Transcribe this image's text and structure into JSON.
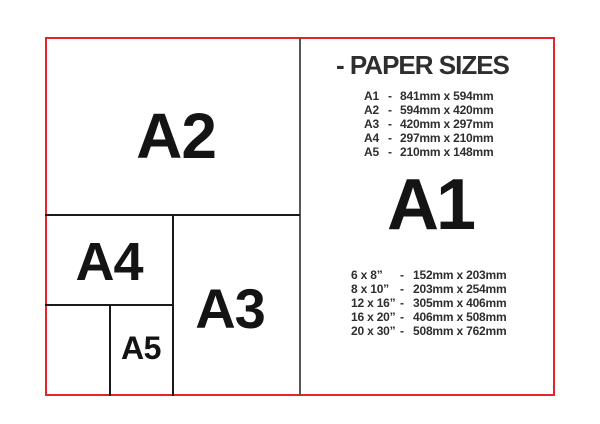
{
  "palette": {
    "frame_red": "#e8242a",
    "line_black": "#1a1a1a",
    "divider_gray": "#575757",
    "text_dark": "#2e2e2e",
    "label_black": "#141414"
  },
  "diagram": {
    "sheets": {
      "a2": "A2",
      "a3": "A3",
      "a4": "A4",
      "a5": "A5"
    }
  },
  "panel": {
    "title": "- PAPER SIZES",
    "featured_size": "A1",
    "a_series": [
      {
        "label": "A1",
        "dash": "-",
        "value": "841mm x 594mm"
      },
      {
        "label": "A2",
        "dash": "-",
        "value": "594mm x 420mm"
      },
      {
        "label": "A3",
        "dash": "-",
        "value": "420mm x 297mm"
      },
      {
        "label": "A4",
        "dash": "-",
        "value": "297mm x 210mm"
      },
      {
        "label": "A5",
        "dash": "-",
        "value": "210mm x 148mm"
      }
    ],
    "inch_series": [
      {
        "label": "6 x 8”",
        "dash": "-",
        "value": "152mm x 203mm"
      },
      {
        "label": "8 x 10”",
        "dash": "-",
        "value": "203mm x 254mm"
      },
      {
        "label": "12 x 16”",
        "dash": "-",
        "value": "305mm x 406mm"
      },
      {
        "label": "16 x 20”",
        "dash": "-",
        "value": "406mm x 508mm"
      },
      {
        "label": "20 x 30”",
        "dash": "-",
        "value": "508mm x 762mm"
      }
    ]
  }
}
